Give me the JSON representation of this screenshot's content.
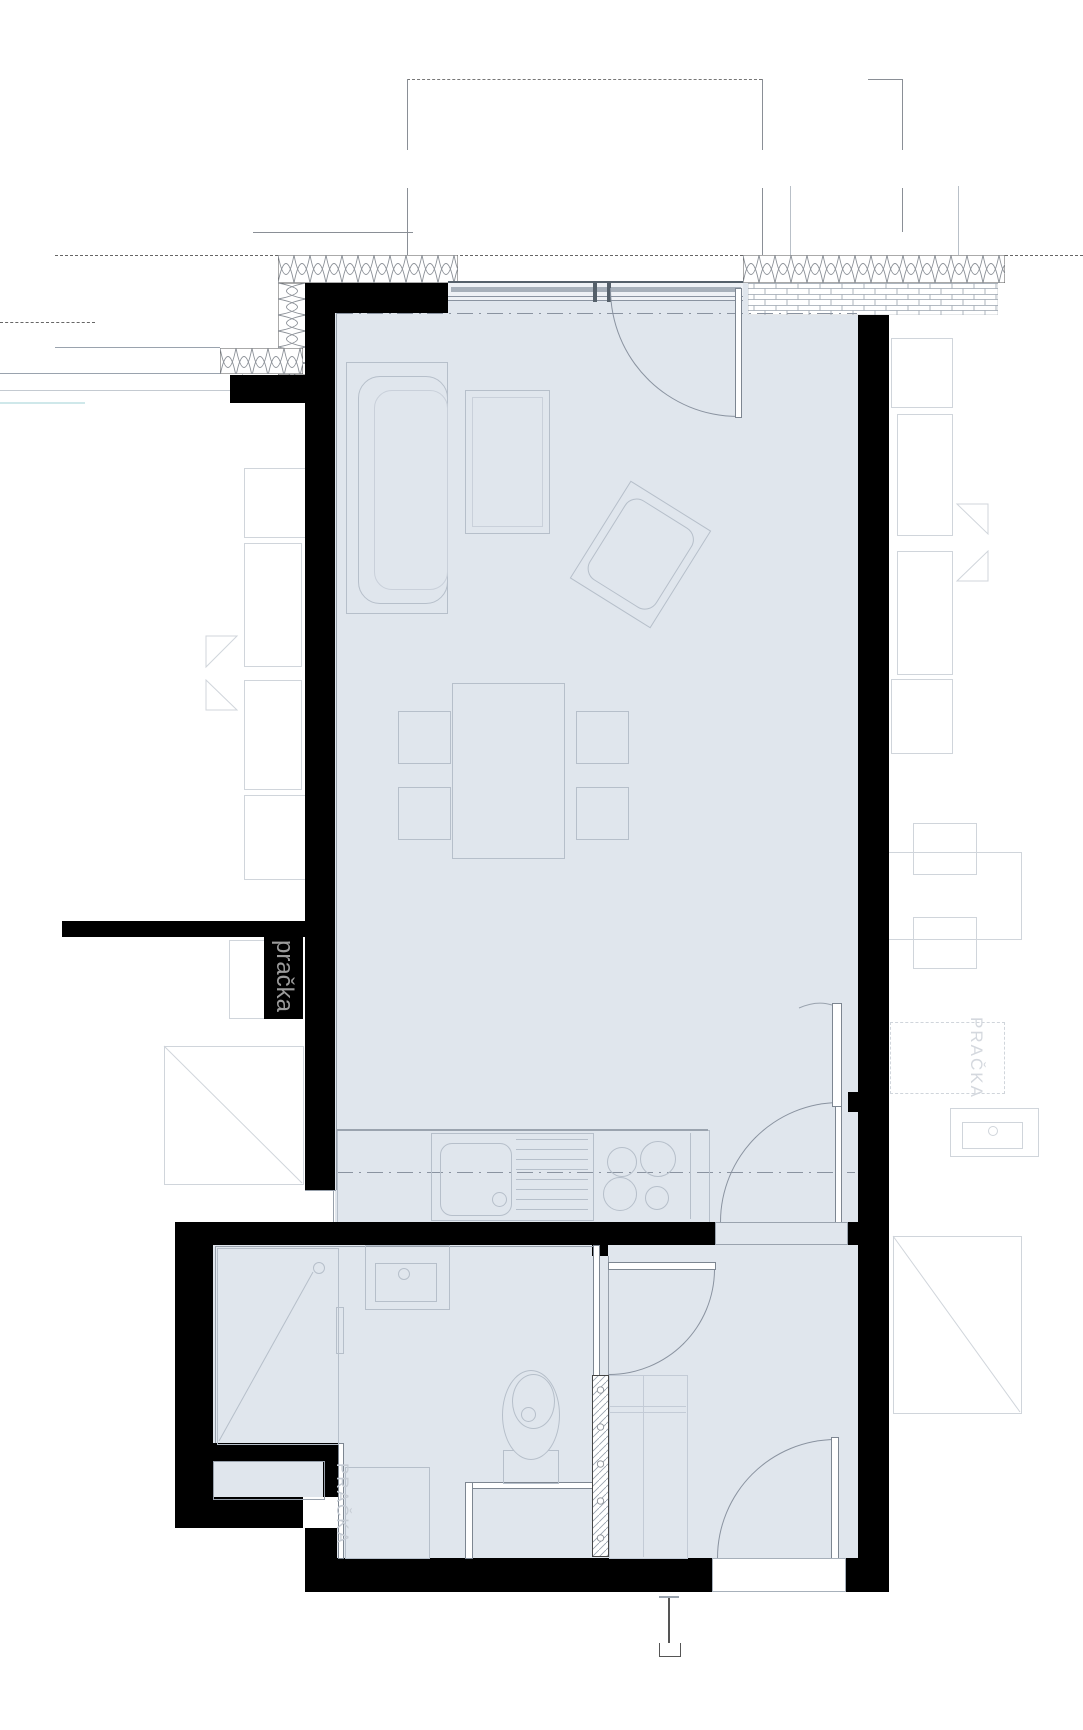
{
  "title": "apartment-floor-plan",
  "labels": {
    "washer_box": "pračka",
    "washer_bath": "PRAČKA",
    "washer_neighbor": "PRAČKA"
  },
  "palette": {
    "floor": "#e0e6ed",
    "wall": "#000000",
    "fixture_line": "#b6bfca",
    "neighbor_line": "#d0d5db",
    "wall_face_line": "#97a0ab",
    "window_band": "#a7b0ba",
    "insulation_hatch": "#8a8f96",
    "label_on_black": "#9b9b9b",
    "label_faint": "#c6ccd4"
  },
  "icons": [
    "sofa-icon",
    "coffee-table-icon",
    "armchair-icon",
    "dining-table-icon",
    "chair-icon",
    "kitchen-counter-icon",
    "kitchen-sink-icon",
    "cooktop-icon",
    "shower-icon",
    "washbasin-icon",
    "toilet-icon",
    "washing-machine-icon",
    "door-swing-icon",
    "window-icon",
    "insulation-hatch-icon",
    "brick-hatch-icon",
    "duct-shaft-icon",
    "section-marker-icon",
    "balcony-outline-icon"
  ]
}
